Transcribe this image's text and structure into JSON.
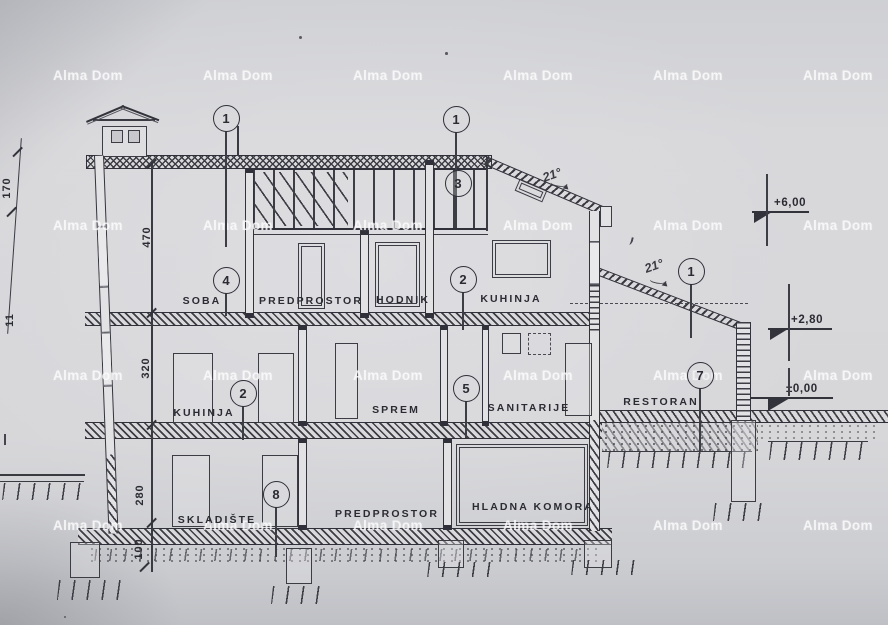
{
  "watermark": {
    "text": "Alma Dom"
  },
  "watermark_grid": {
    "cols": [
      53,
      203,
      353,
      503,
      653,
      803
    ],
    "rows": [
      68,
      218,
      368,
      518
    ]
  },
  "rooms": [
    {
      "label": "SOBA",
      "x": 202,
      "y": 301
    },
    {
      "label": "PREDPROSTOR",
      "x": 311,
      "y": 301
    },
    {
      "label": "HODNIK",
      "x": 403,
      "y": 300
    },
    {
      "label": "KUHINJA",
      "x": 511,
      "y": 299
    },
    {
      "label": "KUHINJA",
      "x": 204,
      "y": 413
    },
    {
      "label": "SPREM",
      "x": 396,
      "y": 410
    },
    {
      "label": "SANITARIJE",
      "x": 529,
      "y": 408
    },
    {
      "label": "RESTORAN",
      "x": 661,
      "y": 402
    },
    {
      "label": "SKLADIŠTE",
      "x": 217,
      "y": 520
    },
    {
      "label": "PREDPROSTOR",
      "x": 387,
      "y": 514
    },
    {
      "label": "HLADNA KOMORA",
      "x": 533,
      "y": 507
    }
  ],
  "markers": [
    {
      "n": "1",
      "x": 226,
      "y": 118,
      "leader_end": 247
    },
    {
      "n": "1",
      "x": 456,
      "y": 119,
      "leader_end": 228
    },
    {
      "n": "3",
      "x": 458,
      "y": 183,
      "leader_end": null
    },
    {
      "n": "4",
      "x": 226,
      "y": 280,
      "leader_end": 316
    },
    {
      "n": "2",
      "x": 463,
      "y": 279,
      "leader_end": 330
    },
    {
      "n": "2",
      "x": 243,
      "y": 393,
      "leader_end": 440
    },
    {
      "n": "5",
      "x": 466,
      "y": 388,
      "leader_end": 438
    },
    {
      "n": "7",
      "x": 700,
      "y": 375,
      "leader_end": 452
    },
    {
      "n": "8",
      "x": 276,
      "y": 494,
      "leader_end": 557
    },
    {
      "n": "1",
      "x": 691,
      "y": 271,
      "leader_end": 338
    }
  ],
  "dimensions": [
    {
      "label": "470",
      "x": 147,
      "y": 237
    },
    {
      "label": "320",
      "x": 146,
      "y": 368
    },
    {
      "label": "280",
      "x": 140,
      "y": 495
    },
    {
      "label": "100",
      "x": 139,
      "y": 549
    },
    {
      "label": "170",
      "x": 7,
      "y": 188
    },
    {
      "label": "11",
      "x": 10,
      "y": 320
    }
  ],
  "elevations": [
    {
      "label": "+6,00",
      "lx": 752,
      "ly": 211,
      "lw": 57,
      "tx": 754,
      "tw": 18,
      "th": 11,
      "txt_x": 774,
      "vx": 766,
      "v1": 174,
      "v2": 246
    },
    {
      "label": "+2,80",
      "lx": 768,
      "ly": 328,
      "lw": 64,
      "tx": 770,
      "tw": 18,
      "th": 11,
      "txt_x": 791,
      "vx": 788,
      "v1": 284,
      "v2": 361
    },
    {
      "label": "±0,00",
      "lx": 750,
      "ly": 397,
      "lw": 83,
      "tx": 768,
      "tw": 22,
      "th": 13,
      "txt_x": 786,
      "vx": 788,
      "v1": 368,
      "v2": 396
    }
  ],
  "slope_notes": [
    {
      "label": "21°",
      "x": 552,
      "y": 175,
      "ax": 551,
      "ay": 179
    },
    {
      "label": "21°",
      "x": 654,
      "y": 266,
      "ax": 650,
      "ay": 276
    }
  ]
}
